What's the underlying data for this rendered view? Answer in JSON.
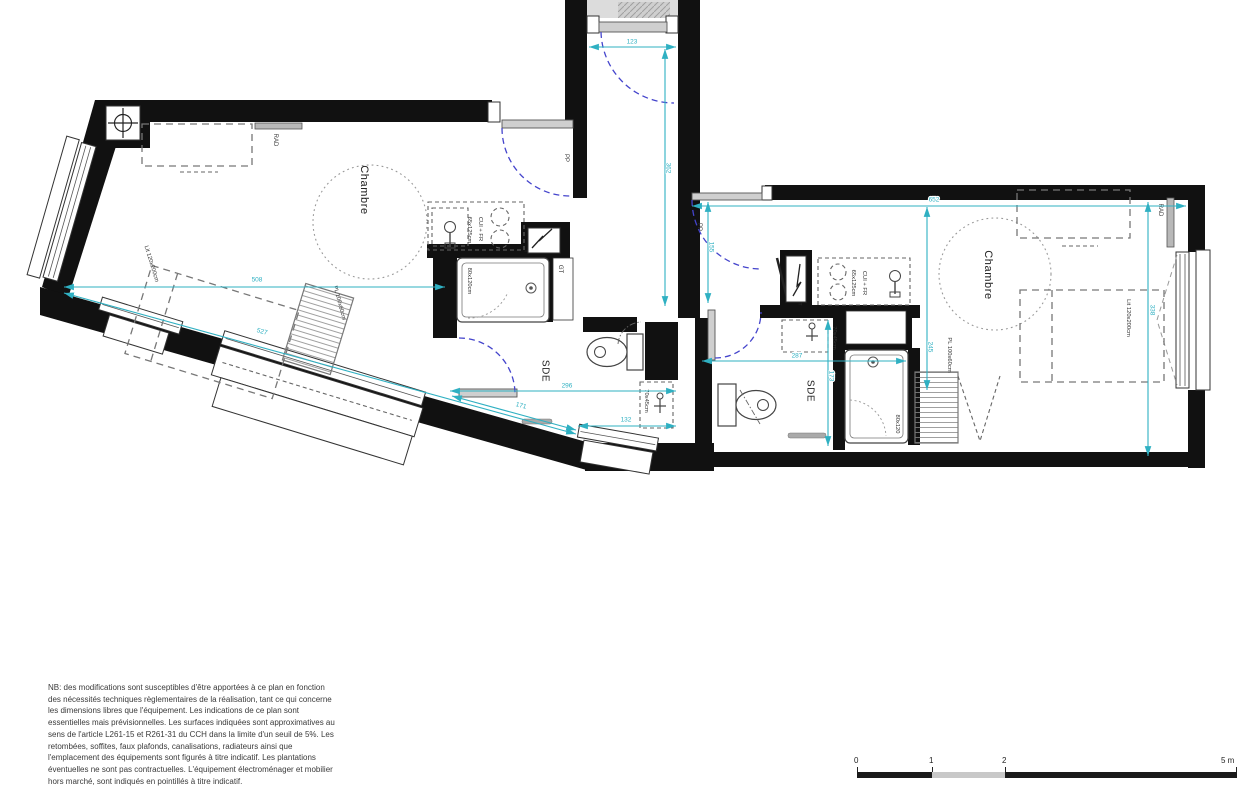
{
  "plan": {
    "rooms": {
      "bedroom": "Chambre",
      "bathroom": "SDE"
    },
    "equipment": {
      "radiator": "RAD",
      "entry_door": "PP",
      "duct": "GT",
      "panel": "T",
      "kitchen": "CUI + FR",
      "kitchen_size": "65x125cm",
      "shower_left": "80x120cm",
      "shower_right": "80x120",
      "basin": "70x45cm",
      "bed": "Lit 120x200cm",
      "closet": "PL 100x60cm"
    },
    "dims": {
      "d123": "123",
      "d362": "362",
      "d508": "508",
      "d527": "527",
      "d296": "296",
      "d171": "171",
      "d132": "132",
      "d652": "652",
      "d155": "155",
      "d287": "287",
      "d173": "173",
      "d245": "245",
      "d338": "338"
    }
  },
  "disclaimer": {
    "lines": [
      "NB: des modifications sont susceptibles d'être apportées à ce plan en fonction",
      "des nécessités techniques règlementaires de la réalisation, tant ce qui concerne",
      "les dimensions libres que l'équipement. Les indications de ce plan sont",
      "essentielles mais prévisionnelles. Les surfaces indiquées sont approximatives au",
      "sens de l'article L261-15 et R261-31 du CCH dans la limite d'un seuil de 5%. Les",
      "retombées, soffites, faux plafonds, canalisations, radiateurs ainsi que",
      "l'emplacement des équipements sont figurés à titre indicatif. Les plantations",
      "éventuelles ne sont pas contractuelles. L'équipement électroménager et mobilier",
      "hors marché,  sont indiqués en pointillés à titre indicatif."
    ]
  },
  "scalebar": {
    "t0": "0",
    "t1": "1",
    "t2": "2",
    "t5": "5 m"
  },
  "colors": {
    "dimension": "#2fb0c2",
    "door_swing": "#4444cc",
    "wall": "#111111"
  }
}
